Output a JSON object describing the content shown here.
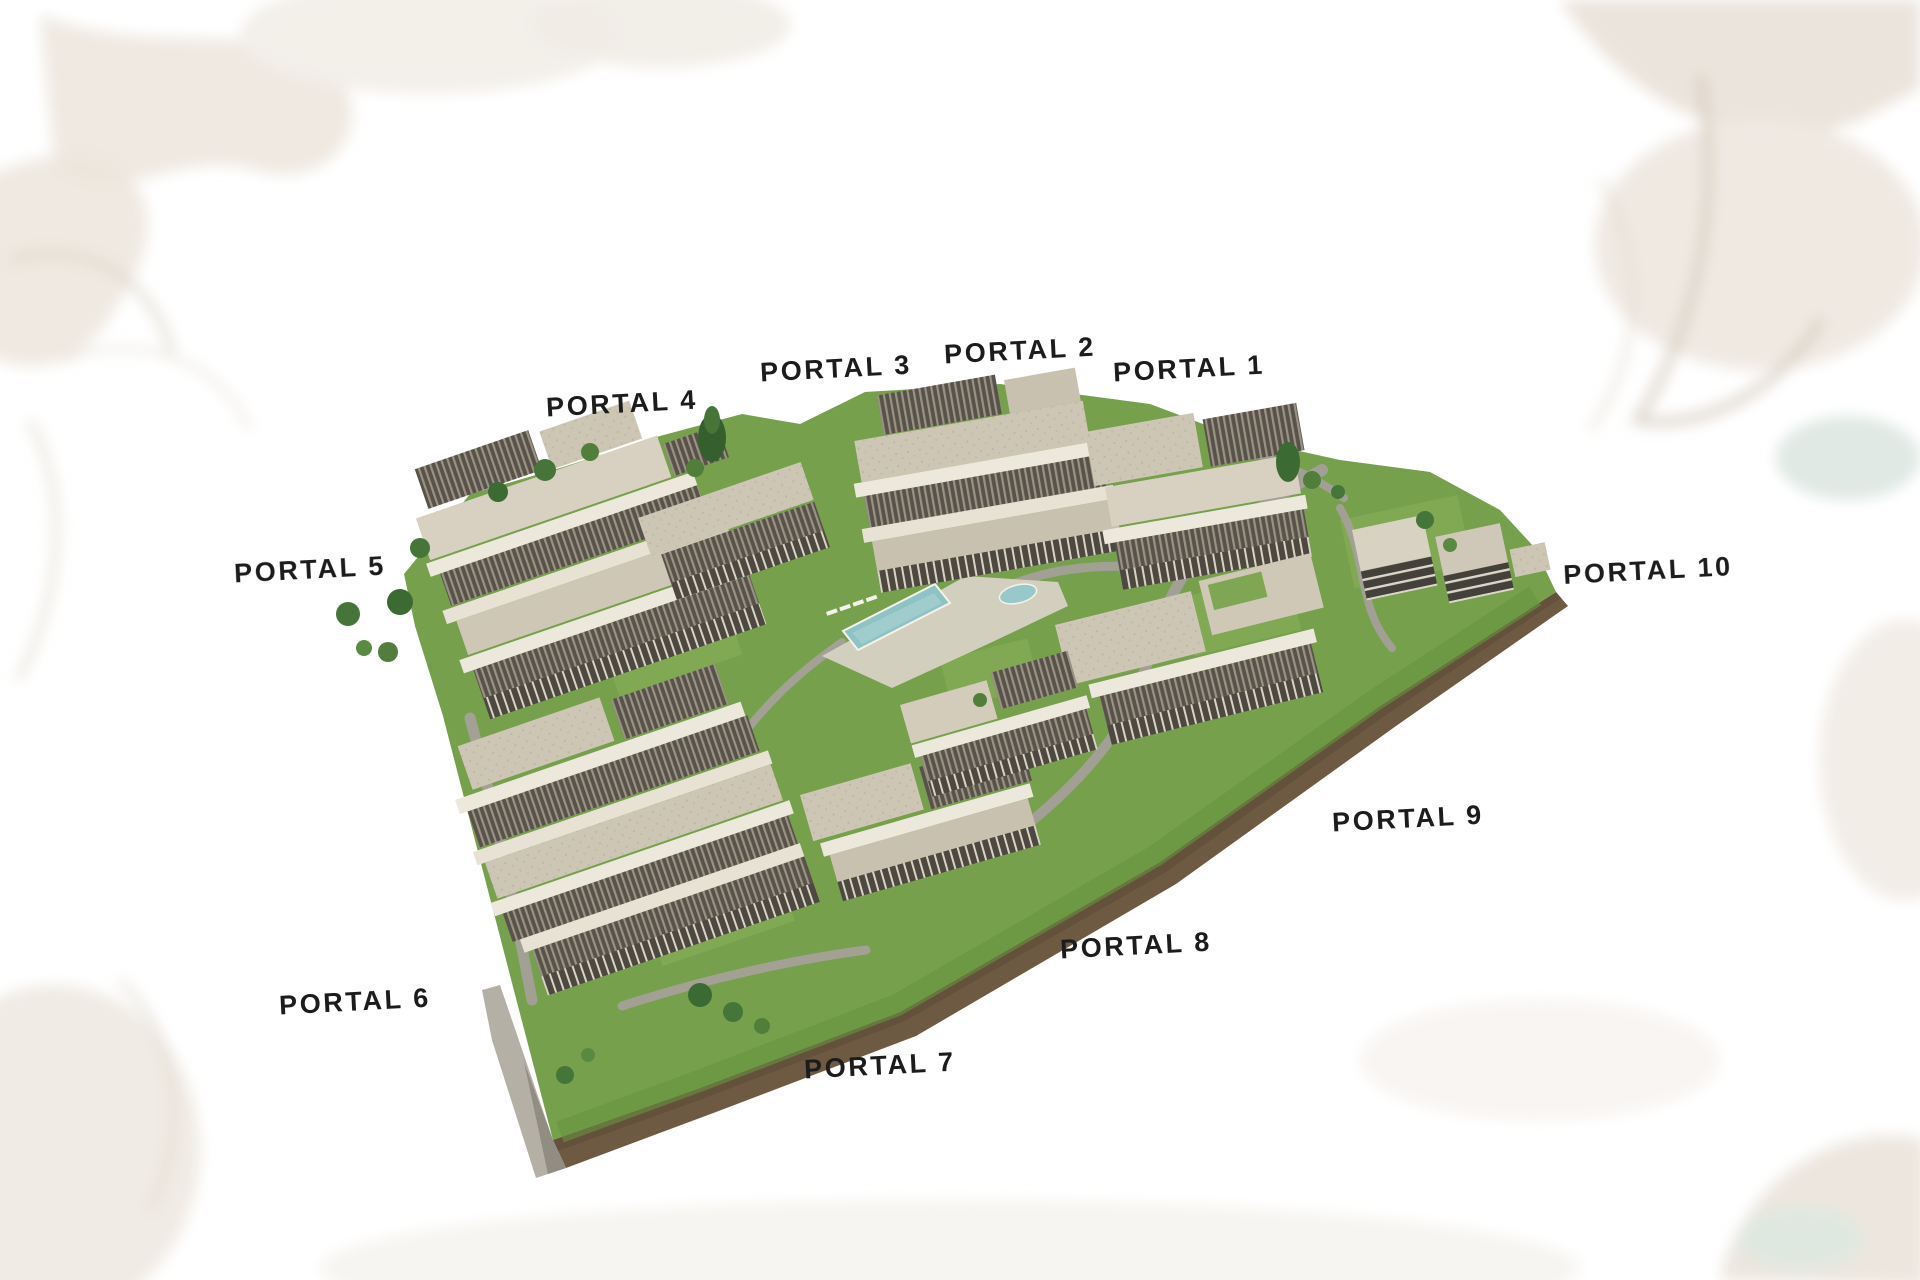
{
  "page": {
    "kind": "real-estate masterplan rendering",
    "background_color": "#ffffff"
  },
  "portals": [
    {
      "id": "portal-1",
      "label": "PORTAL 1"
    },
    {
      "id": "portal-2",
      "label": "PORTAL 2"
    },
    {
      "id": "portal-3",
      "label": "PORTAL 3"
    },
    {
      "id": "portal-4",
      "label": "PORTAL 4"
    },
    {
      "id": "portal-5",
      "label": "PORTAL 5"
    },
    {
      "id": "portal-6",
      "label": "PORTAL 6"
    },
    {
      "id": "portal-7",
      "label": "PORTAL 7"
    },
    {
      "id": "portal-8",
      "label": "PORTAL 8"
    },
    {
      "id": "portal-9",
      "label": "PORTAL 9"
    },
    {
      "id": "portal-10",
      "label": "PORTAL 10"
    }
  ],
  "scene": {
    "description": "3D aerial rendering of a terraced residential complex on a triangular landscaped plot with a central swimming pool, lawns, trees, walkways and a perimeter retaining wall; ten building entrances labelled Portal 1-10",
    "features": [
      "swimming-pool",
      "kids-pool",
      "sun-loungers",
      "lawns",
      "trees",
      "walkways",
      "earth-retaining-wall"
    ],
    "colors": {
      "label_text": "#1c1c1c",
      "grass": "#76a04c",
      "building_roof_light": "#d8d1c1",
      "building_roof_stone": "#cec6b5",
      "roof_louver_dark": "#57524a",
      "facade_window_band": "#4d4941",
      "terrace_slab": "#ece8dc",
      "pool_water": "#8fc2c5",
      "earth_wall": "#6e5a42",
      "path_gray": "#a5a198",
      "background_art": "#eae3da"
    }
  }
}
